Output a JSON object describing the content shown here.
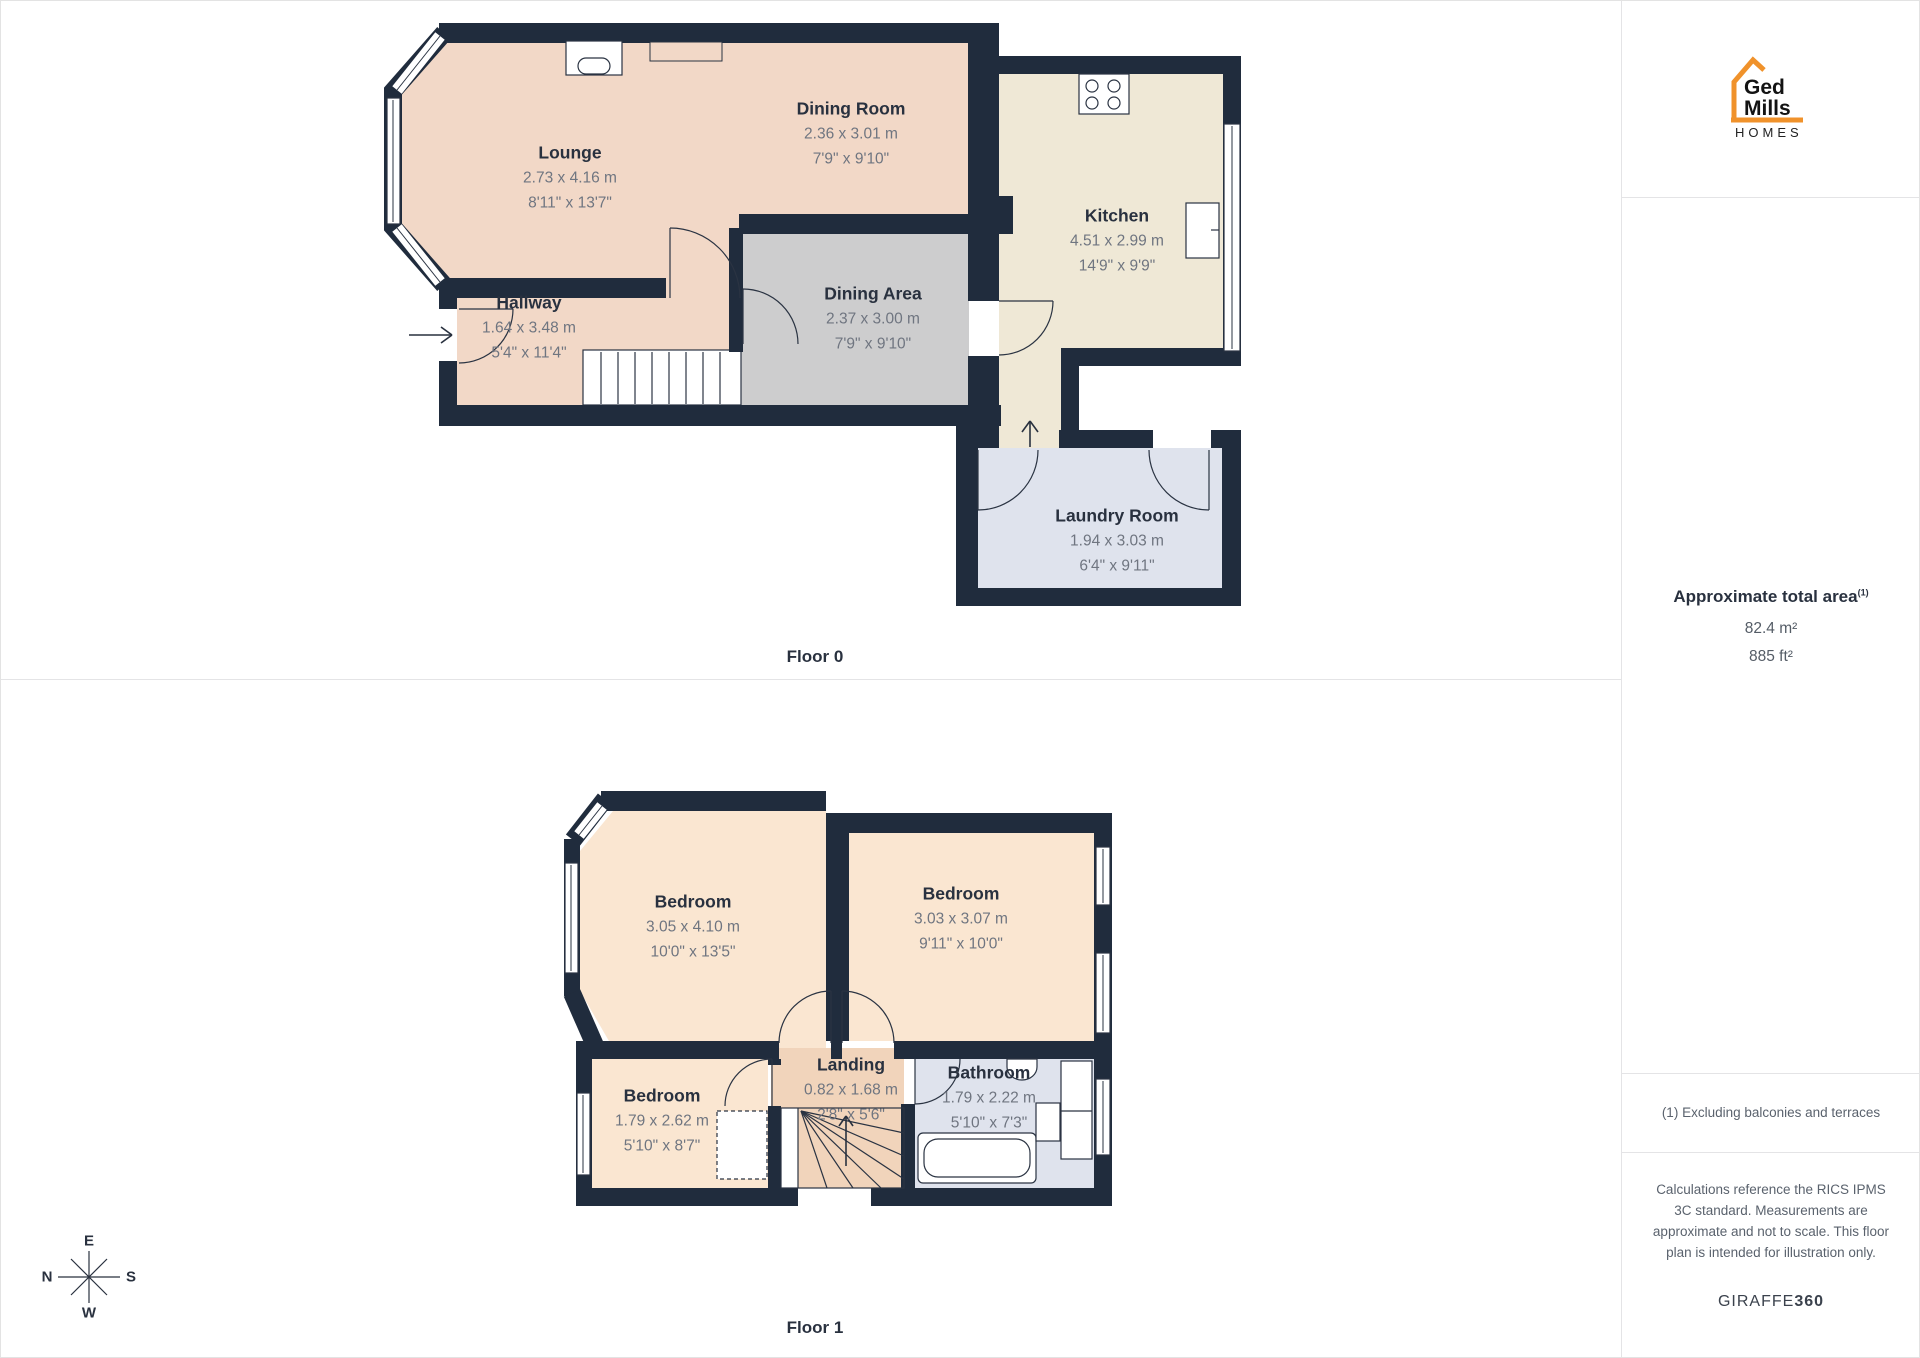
{
  "floor0": {
    "label": "Floor 0",
    "rooms": {
      "lounge": {
        "name": "Lounge",
        "dim_m": "2.73 x 4.16 m",
        "dim_ft": "8'11\" x 13'7\""
      },
      "dining_room": {
        "name": "Dining Room",
        "dim_m": "2.36 x 3.01 m",
        "dim_ft": "7'9\" x 9'10\""
      },
      "kitchen": {
        "name": "Kitchen",
        "dim_m": "4.51 x 2.99 m",
        "dim_ft": "14'9\" x 9'9\""
      },
      "hallway": {
        "name": "Hallway",
        "dim_m": "1.64 x 3.48 m",
        "dim_ft": "5'4\" x 11'4\""
      },
      "dining_area": {
        "name": "Dining Area",
        "dim_m": "2.37 x 3.00 m",
        "dim_ft": "7'9\" x 9'10\""
      },
      "laundry": {
        "name": "Laundry Room",
        "dim_m": "1.94 x 3.03 m",
        "dim_ft": "6'4\" x 9'11\""
      }
    }
  },
  "floor1": {
    "label": "Floor 1",
    "rooms": {
      "bedroom_left": {
        "name": "Bedroom",
        "dim_m": "3.05 x 4.10 m",
        "dim_ft": "10'0\" x 13'5\""
      },
      "bedroom_right": {
        "name": "Bedroom",
        "dim_m": "3.03 x 3.07 m",
        "dim_ft": "9'11\" x 10'0\""
      },
      "bedroom_small": {
        "name": "Bedroom",
        "dim_m": "1.79 x 2.62 m",
        "dim_ft": "5'10\" x 8'7\""
      },
      "landing": {
        "name": "Landing",
        "dim_m": "0.82 x 1.68 m",
        "dim_ft": "2'8\" x 5'6\""
      },
      "bathroom": {
        "name": "Bathroom",
        "dim_m": "1.79 x 2.22 m",
        "dim_ft": "5'10\" x 7'3\""
      }
    }
  },
  "compass": {
    "top": "E",
    "left": "N",
    "right": "S",
    "bottom": "W"
  },
  "sidebar": {
    "logo": {
      "line1": "Ged",
      "line2": "Mills",
      "line3": "HOMES"
    },
    "area": {
      "title": "Approximate total area",
      "footnote_ref": "(1)",
      "value_m2": "82.4 m²",
      "value_ft2": "885 ft²"
    },
    "note": "(1) Excluding balconies and terraces",
    "disclaimer": "Calculations reference the RICS IPMS 3C standard. Measurements are approximate and not to scale. This floor plan is intended for illustration only.",
    "brand": {
      "name": "GIRAFFE",
      "suffix": "360"
    }
  },
  "colors": {
    "wall": "#202c3d",
    "line": "#2a3342",
    "ink": "#29313f",
    "dim_ink": "#6f7580",
    "f0_peach": "#f2d8c7",
    "f0_gray": "#cdcdce",
    "f0_cream": "#efe8d6",
    "blue_room": "#dfe3ed",
    "f1_peach": "#fae6d1",
    "tan": "#f1d4bb",
    "accent_orange": "#f0922b",
    "divider": "#e4e4e6"
  }
}
